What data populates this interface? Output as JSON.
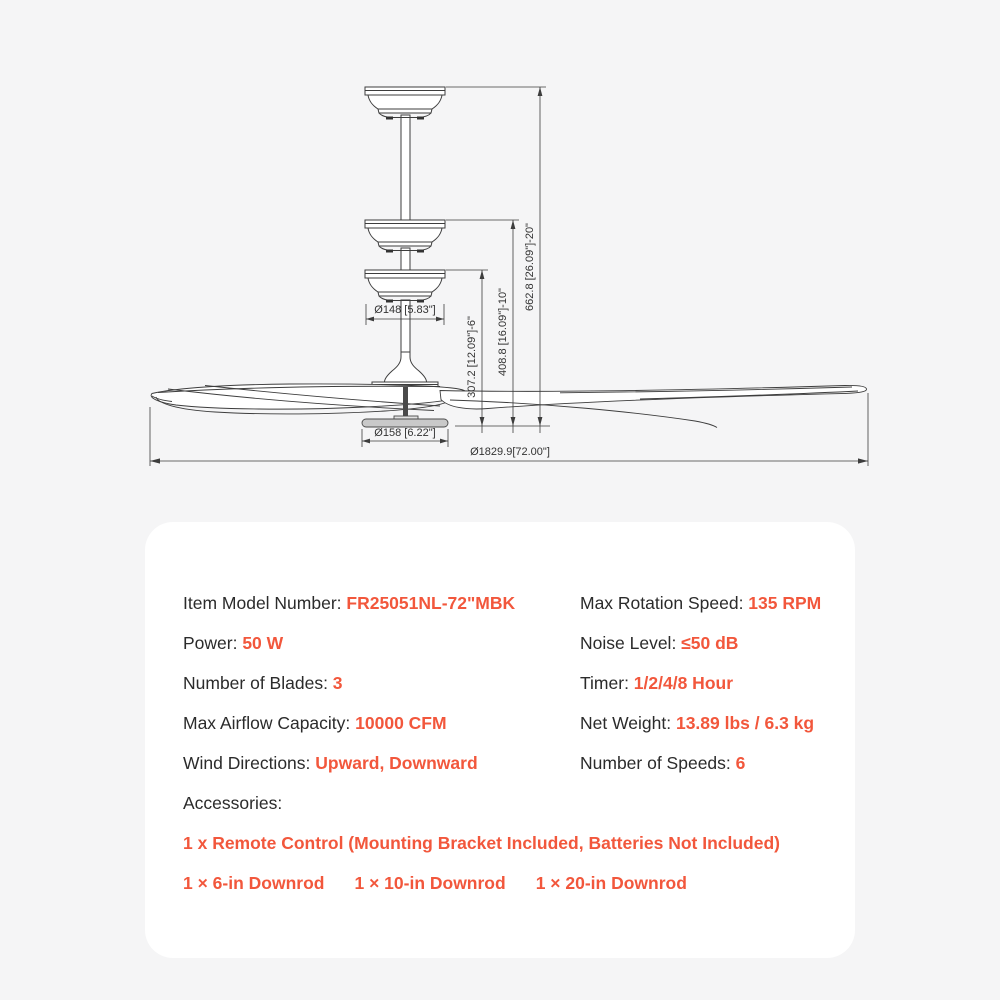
{
  "page": {
    "accent_color": "#f2573c",
    "text_color": "#2b2b2b",
    "background_color": "#f5f5f6",
    "panel_color": "#ffffff"
  },
  "diagram": {
    "dim_canopy_diameter": "Ø148 [5.83\"]",
    "dim_lightkit_diameter": "Ø158 [6.22\"]",
    "dim_overall_diameter": "Ø1829.9[72.00\"]",
    "dim_height_6in_downrod": "307.2 [12.09\"]-6\"",
    "dim_height_10in_downrod": "408.8 [16.09\"]-10\"",
    "dim_height_20in_downrod": "662.8 [26.09\"]-20\""
  },
  "specs": {
    "left": [
      {
        "label": "Item Model Number: ",
        "value": "FR25051NL-72\"MBK"
      },
      {
        "label": "Power: ",
        "value": "50 W"
      },
      {
        "label": "Number of Blades: ",
        "value": "3"
      },
      {
        "label": "Max Airflow Capacity: ",
        "value": "10000 CFM"
      },
      {
        "label": "Wind Directions: ",
        "value": "Upward, Downward"
      }
    ],
    "right": [
      {
        "label": "Max Rotation Speed: ",
        "value": "135 RPM"
      },
      {
        "label": "Noise Level: ",
        "value": "≤50 dB"
      },
      {
        "label": "Timer: ",
        "value": "1/2/4/8 Hour"
      },
      {
        "label": "Net Weight: ",
        "value": "13.89 lbs / 6.3 kg"
      },
      {
        "label": "Number of Speeds: ",
        "value": "6"
      }
    ],
    "accessories_label": "Accessories:",
    "accessories_line1": "1 x Remote Control (Mounting Bracket Included, Batteries Not Included)",
    "downrods": [
      "1 × 6-in Downrod",
      "1 × 10-in Downrod",
      "1 × 20-in Downrod"
    ]
  }
}
